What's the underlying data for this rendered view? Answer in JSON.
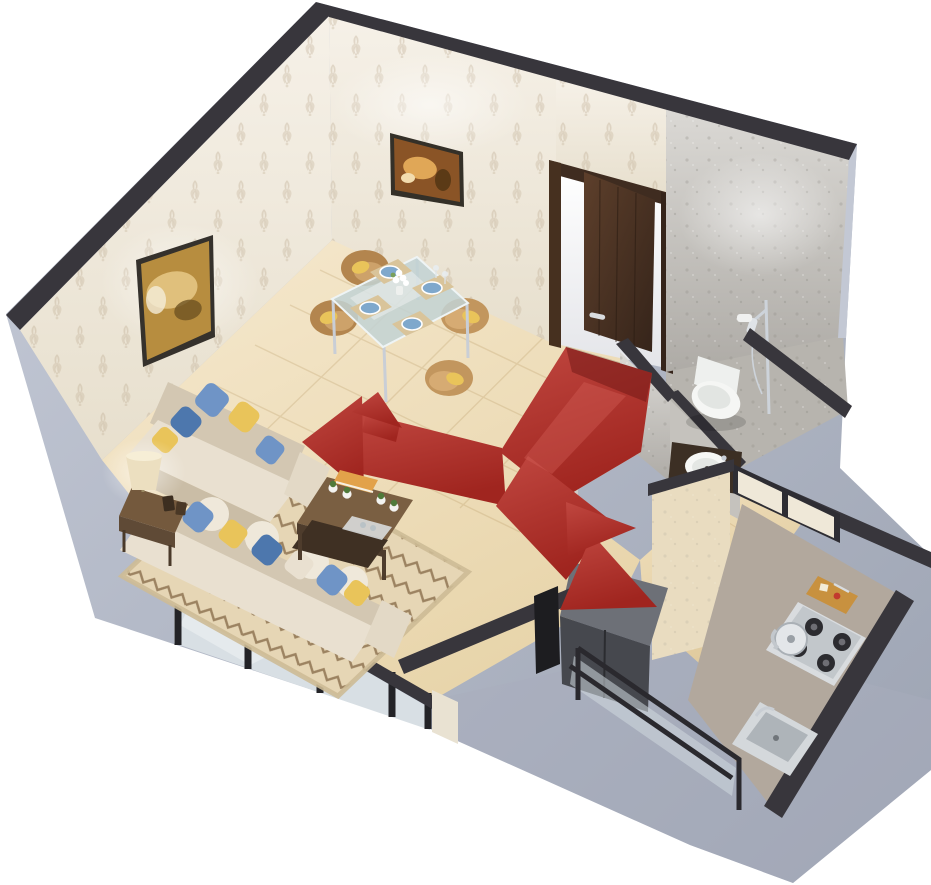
{
  "title": "3D isometric cutaway floor plan of a one-room apartment with red entry circulation arrows",
  "background_color": "#ffffff",
  "palette": {
    "wall_top": "#38363c",
    "exterior_wall_light": "#c6cbd8",
    "exterior_wall_dark": "#9ca3b2",
    "wallpaper": "#f2ecdf",
    "wallpaper_motif": "#c2b096",
    "granite_wall": "#cfccc7",
    "marble_floor": "#f1e3c4",
    "bathroom_floor": "#b7b4ae",
    "kitchen_floor": "#eedcba",
    "flow_red": "#b5322e",
    "flow_red_bright": "#c8514a",
    "flow_red_dark": "#8e2321",
    "door_wood": "#4e3526",
    "sofa_cream": "#e9e0d0",
    "sofa_shade": "#d3c7b2",
    "pillow_blue": "#6f94c6",
    "pillow_yellow": "#e9c45a",
    "rug_base": "#e6d6b5",
    "rug_zigzag": "#8a6e4c",
    "wood_dark": "#5f4a36",
    "chair_tan": "#c2965e",
    "fixture_white": "#f4f5f3",
    "counter_taupe": "#b2a89d",
    "steel": "#d9dcdf",
    "frame_black": "#26262a",
    "glass": "#d8dfe4"
  },
  "scene": {
    "view": "isometric dollhouse cutaway, walls cut at front, transparent background",
    "rooms": [
      {
        "name": "Living room",
        "contents": [
          "L-shaped cream sofa with blue, yellow and white throw pillows",
          "wooden side table with cream table lamp and picture frames",
          "dark-wood two-tier coffee table with books, four small potted plants and a tray",
          "beige area rug with brown zigzag pattern",
          "gold abstract wall art on patterned wallpaper"
        ]
      },
      {
        "name": "Dining area",
        "contents": [
          "glass-top dining table with chrome legs",
          "4 tan tub chairs with yellow cushions",
          "4 blue place settings on beige placemats",
          "white flower centerpiece and stemware",
          "warm still-life wall art"
        ]
      },
      {
        "name": "Entry hallway",
        "contents": [
          "open dark-wood entry door with lever handle",
          "red circulation path painted on marble floor"
        ]
      },
      {
        "name": "Bathroom",
        "contents": [
          "white toilet against granite wall",
          "handheld shower on chrome rail",
          "round white basin on dark vanity counter",
          "black framed window"
        ]
      },
      {
        "name": "Kitchen",
        "contents": [
          "stainless 4-burner gas hob with kettle",
          "wooden cutting board with food and knife",
          "stainless sink in taupe counter",
          "dark refrigerator cabinet",
          "glass balustrade at the open front",
          "window over the half wall"
        ]
      },
      {
        "name": "Balcony front",
        "contents": [
          "black-framed sliding glass windows along the lower-left wall"
        ]
      }
    ],
    "flow_arrows": {
      "color": "#b5322e",
      "origin": "entry door",
      "branches": [
        {
          "to": "living room",
          "head": "large arrowhead pointing left"
        },
        {
          "to": "dining area",
          "head": "small arrowhead pointing up"
        },
        {
          "to": "kitchen",
          "head": "large arrowhead pointing lower-right"
        },
        {
          "to": "bathroom passage",
          "head": "small arrowhead pointing upper-right"
        }
      ]
    },
    "counts": {
      "dining_chairs": 4,
      "wall_paintings": 2,
      "sofa_throw_pillows": 11,
      "coffee_table_planters": 4,
      "flow_arrowheads": 4
    }
  }
}
